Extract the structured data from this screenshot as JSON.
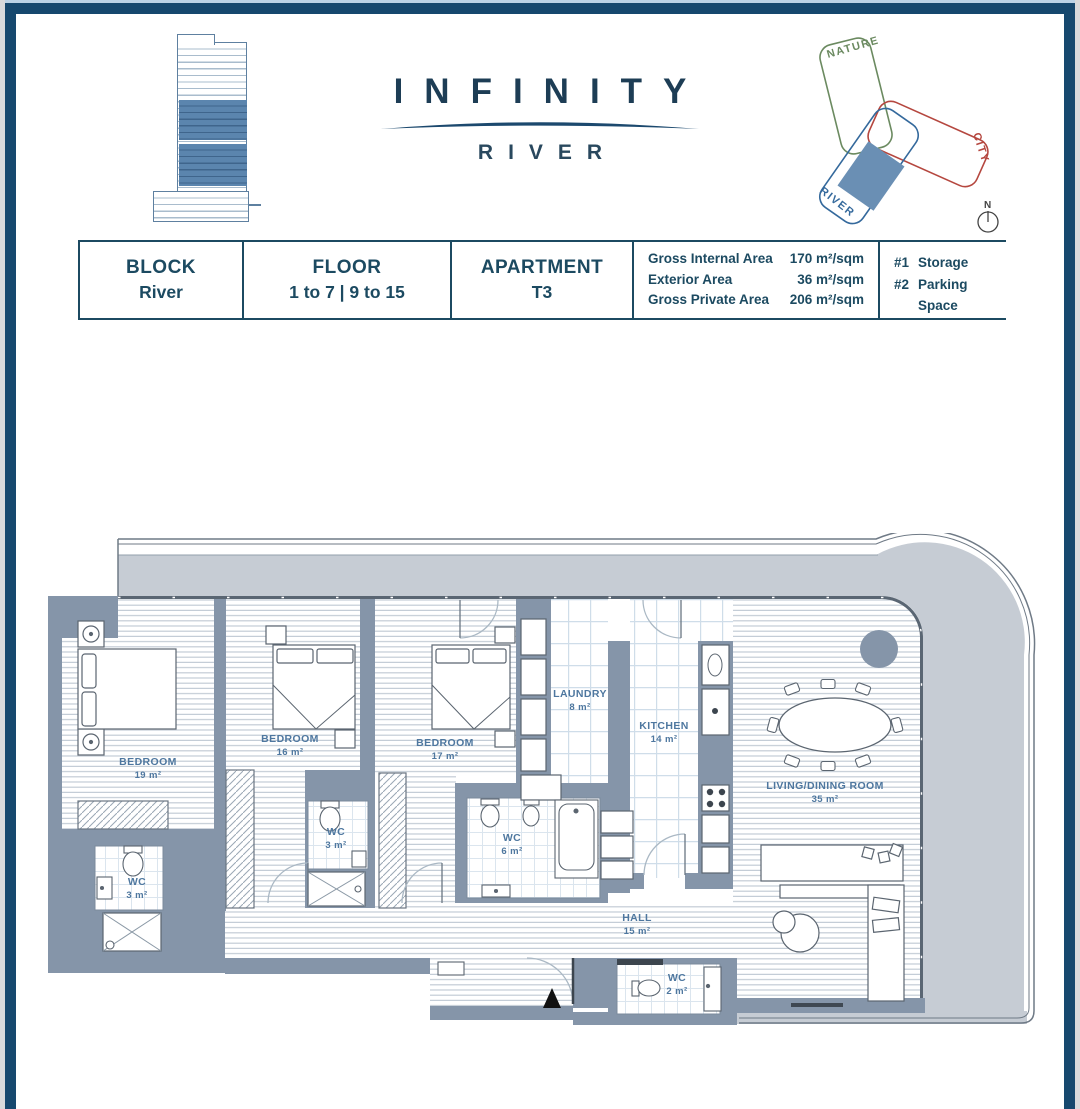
{
  "brand": {
    "name_top": "INFINITY",
    "name_bottom": "RIVER"
  },
  "site_diagram": {
    "wing_nature": "NATURE",
    "wing_city": "CITY",
    "wing_river": "RIVER",
    "compass_north": "N"
  },
  "info_table": {
    "block": {
      "label": "BLOCK",
      "value": "River"
    },
    "floor": {
      "label": "FLOOR",
      "value": "1 to 7 | 9 to 15"
    },
    "apartment": {
      "label": "APARTMENT",
      "value": "T3"
    },
    "areas": [
      {
        "label": "Gross Internal Area",
        "value": "170 m²/sqm"
      },
      {
        "label": "Exterior Area",
        "value": "36 m²/sqm"
      },
      {
        "label": "Gross Private Area",
        "value": "206 m²/sqm"
      }
    ],
    "allocations": [
      {
        "label": "#1",
        "value": "Storage"
      },
      {
        "label": "#2",
        "value": "Parking Space"
      }
    ]
  },
  "floor_plan": {
    "rooms": [
      {
        "name": "BEDROOM",
        "area": "19 m²"
      },
      {
        "name": "BEDROOM",
        "area": "16 m²"
      },
      {
        "name": "BEDROOM",
        "area": "17 m²"
      },
      {
        "name": "LAUNDRY",
        "area": "8 m²"
      },
      {
        "name": "KITCHEN",
        "area": "14 m²"
      },
      {
        "name": "LIVING/DINING ROOM",
        "area": "35 m²"
      },
      {
        "name": "WC",
        "area": "3 m²"
      },
      {
        "name": "WC",
        "area": "3 m²"
      },
      {
        "name": "WC",
        "area": "6 m²"
      },
      {
        "name": "HALL",
        "area": "15 m²"
      },
      {
        "name": "WC",
        "area": "2 m²"
      }
    ]
  },
  "colors": {
    "frame_navy": "#16486e",
    "wall_gray": "#8595a9",
    "terrace_gray": "#c6ccd4",
    "label_blue": "#4e779f",
    "nature_green": "#6b8a60",
    "city_red": "#b5473f",
    "river_blue": "#34699c"
  }
}
